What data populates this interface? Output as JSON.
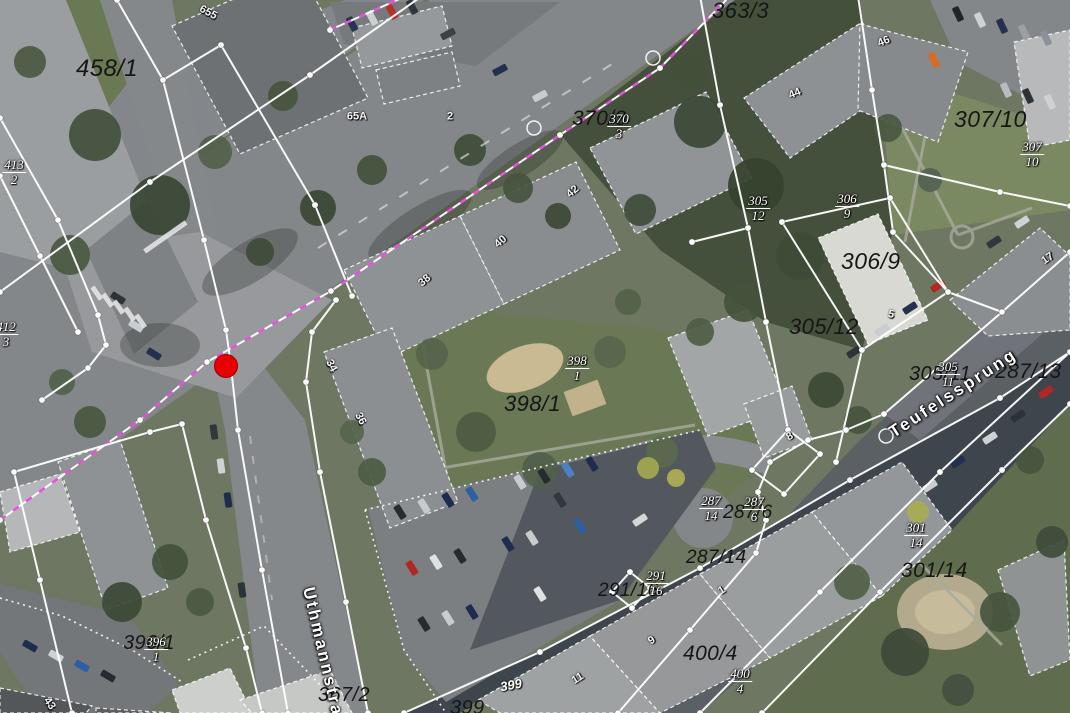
{
  "map": {
    "colors": {
      "parcel_boundary": "#ffffff",
      "surveyed_boundary": "#e84fe0",
      "marker": "#e60000",
      "parcel_label_text": "#161616",
      "street_label_text": "#ffffff"
    },
    "marker": {
      "x": 226,
      "y": 366
    },
    "street_names": [
      {
        "text": "Teufelssprung",
        "x": 953,
        "y": 393,
        "rot": -33
      },
      {
        "text": "Uthmannstraße",
        "x": 326,
        "y": 664,
        "rot": 77
      }
    ],
    "parcel_labels": [
      {
        "text": "458/1",
        "x": 76,
        "y": 57,
        "size": 24
      },
      {
        "text": "363/3",
        "x": 712,
        "y": 0,
        "size": 22
      },
      {
        "text": "370/3",
        "x": 572,
        "y": 108,
        "size": 21
      },
      {
        "text": "307/10",
        "x": 954,
        "y": 108,
        "size": 23
      },
      {
        "text": "306/9",
        "x": 841,
        "y": 250,
        "size": 23
      },
      {
        "text": "305/12",
        "x": 789,
        "y": 316,
        "size": 22
      },
      {
        "text": "398/1",
        "x": 504,
        "y": 393,
        "size": 22
      },
      {
        "text": "305/11",
        "x": 909,
        "y": 364,
        "size": 20
      },
      {
        "text": "287/13",
        "x": 995,
        "y": 361,
        "size": 21
      },
      {
        "text": "301/14",
        "x": 901,
        "y": 560,
        "size": 21
      },
      {
        "text": "287/14",
        "x": 686,
        "y": 548,
        "size": 19
      },
      {
        "text": "287/6",
        "x": 723,
        "y": 503,
        "size": 19
      },
      {
        "text": "291/16",
        "x": 598,
        "y": 581,
        "size": 19
      },
      {
        "text": "400/4",
        "x": 683,
        "y": 643,
        "size": 21
      },
      {
        "text": "367/2",
        "x": 318,
        "y": 685,
        "size": 20
      },
      {
        "text": "396/1",
        "x": 123,
        "y": 633,
        "size": 20
      },
      {
        "text": "399",
        "x": 450,
        "y": 698,
        "size": 20
      }
    ],
    "fraction_labels": [
      {
        "num": "413",
        "den": "2",
        "x": 14,
        "y": 158
      },
      {
        "num": "412",
        "den": "3",
        "x": 6,
        "y": 320
      },
      {
        "num": "",
        "den": "4",
        "x": 688,
        "y": -16
      },
      {
        "num": "370",
        "den": "3",
        "x": 619,
        "y": 112
      },
      {
        "num": "305",
        "den": "12",
        "x": 758,
        "y": 194
      },
      {
        "num": "306",
        "den": "9",
        "x": 847,
        "y": 192
      },
      {
        "num": "307",
        "den": "10",
        "x": 1032,
        "y": 140
      },
      {
        "num": "398",
        "den": "1",
        "x": 577,
        "y": 354
      },
      {
        "num": "305",
        "den": "11",
        "x": 948,
        "y": 360
      },
      {
        "num": "287",
        "den": "14",
        "x": 711,
        "y": 494
      },
      {
        "num": "287",
        "den": "6",
        "x": 754,
        "y": 495
      },
      {
        "num": "291",
        "den": "16",
        "x": 656,
        "y": 569
      },
      {
        "num": "301",
        "den": "14",
        "x": 916,
        "y": 521
      },
      {
        "num": "400",
        "den": "4",
        "x": 740,
        "y": 667
      },
      {
        "num": "396",
        "den": "1",
        "x": 156,
        "y": 635
      }
    ],
    "building_numbers": [
      {
        "text": "655",
        "x": 208,
        "y": 13,
        "rot": 28
      },
      {
        "text": "65A",
        "x": 357,
        "y": 117,
        "rot": 0
      },
      {
        "text": "2",
        "x": 450,
        "y": 117,
        "rot": 0
      },
      {
        "text": "38",
        "x": 425,
        "y": 281,
        "rot": -40
      },
      {
        "text": "40",
        "x": 501,
        "y": 242,
        "rot": -40
      },
      {
        "text": "42",
        "x": 573,
        "y": 192,
        "rot": -40
      },
      {
        "text": "34",
        "x": 331,
        "y": 366,
        "rot": 62
      },
      {
        "text": "36",
        "x": 360,
        "y": 419,
        "rot": 62
      },
      {
        "text": "44",
        "x": 795,
        "y": 94,
        "rot": -22
      },
      {
        "text": "46",
        "x": 884,
        "y": 42,
        "rot": -22
      },
      {
        "text": "5",
        "x": 891,
        "y": 315,
        "rot": 15
      },
      {
        "text": "8",
        "x": 790,
        "y": 437,
        "rot": -30
      },
      {
        "text": "17",
        "x": 1048,
        "y": 259,
        "rot": -35
      },
      {
        "text": "11",
        "x": 578,
        "y": 679,
        "rot": -32
      },
      {
        "text": "9",
        "x": 652,
        "y": 641,
        "rot": -32
      },
      {
        "text": "1",
        "x": 722,
        "y": 591,
        "rot": -32
      },
      {
        "text": "43",
        "x": 49,
        "y": 704,
        "rot": 55
      }
    ],
    "white_labels": [
      {
        "text": "399",
        "x": 511,
        "y": 685,
        "rot": -10
      }
    ]
  }
}
